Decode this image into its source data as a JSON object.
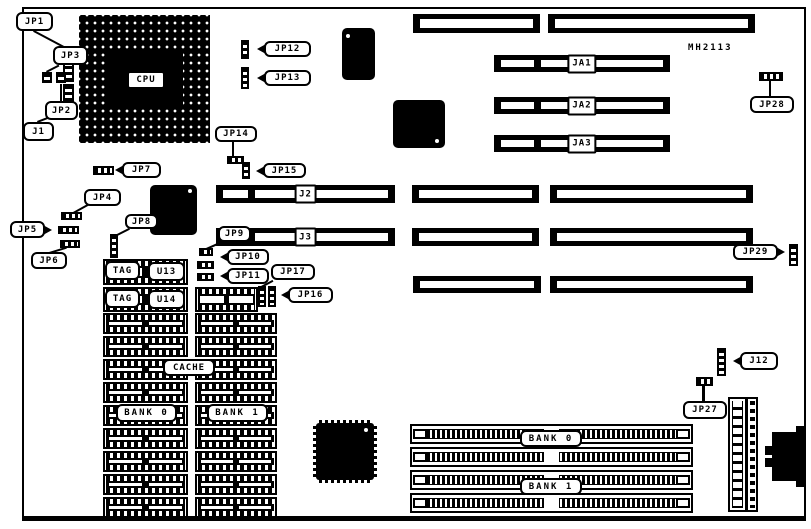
{
  "diagram": {
    "type": "motherboard-jumper-location-diagram",
    "part_number": "MH2113",
    "colors": {
      "ink": "#000000",
      "paper": "#ffffff"
    }
  },
  "labels": {
    "jp1": "JP1",
    "jp2": "JP2",
    "jp3": "JP3",
    "jp4": "JP4",
    "jp5": "JP5",
    "jp6": "JP6",
    "jp7": "JP7",
    "jp8": "JP8",
    "jp9": "JP9",
    "jp10": "JP10",
    "jp11": "JP11",
    "jp12": "JP12",
    "jp13": "JP13",
    "jp14": "JP14",
    "jp15": "JP15",
    "jp16": "JP16",
    "jp17": "JP17",
    "jp27": "JP27",
    "jp28": "JP28",
    "jp29": "JP29",
    "j1": "J1",
    "j2": "J2",
    "j3": "J3",
    "j12": "J12",
    "ja1": "JA1",
    "ja2": "JA2",
    "ja3": "JA3",
    "cpu": "CPU",
    "cache": "CACHE",
    "tag": "TAG",
    "u13": "U13",
    "u14": "U14",
    "bank0": "BANK 0",
    "bank1": "BANK 1",
    "part_number": "MH2113"
  }
}
